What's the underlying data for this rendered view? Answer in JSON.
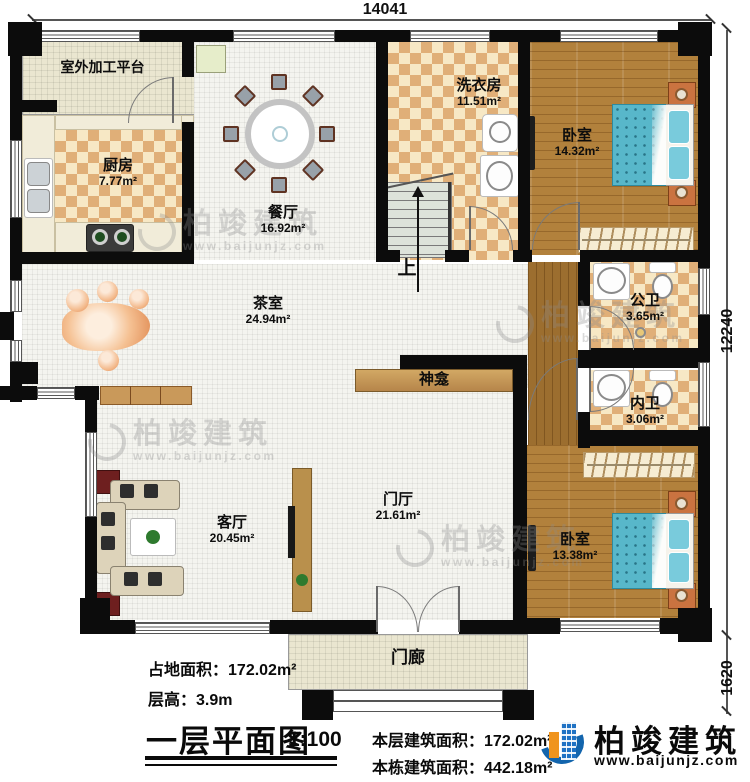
{
  "dimensions": {
    "top": "14041",
    "right_main": "12240",
    "right_porch": "1620"
  },
  "rooms": [
    {
      "name": "室外加工平台",
      "area": ""
    },
    {
      "name": "厨房",
      "area": "7.77m²"
    },
    {
      "name": "餐厅",
      "area": "16.92m²"
    },
    {
      "name": "洗衣房",
      "area": "11.51m²"
    },
    {
      "name": "卧室",
      "area": "14.32m²"
    },
    {
      "name": "茶室",
      "area": "24.94m²"
    },
    {
      "name": "公卫",
      "area": "3.65m²"
    },
    {
      "name": "内卫",
      "area": "3.06m²"
    },
    {
      "name": "神龛",
      "area": ""
    },
    {
      "name": "客厅",
      "area": "20.45m²"
    },
    {
      "name": "门厅",
      "area": "21.61m²"
    },
    {
      "name": "卧室",
      "area": "13.38m²"
    },
    {
      "name": "门廊",
      "area": ""
    }
  ],
  "stairs": {
    "up_label": "上"
  },
  "info": {
    "land_area_label": "占地面积：",
    "land_area_value": "172.02m²",
    "floor_height_label": "层高：",
    "floor_height_value": "3.9m"
  },
  "titleblock": {
    "title": "一层平面图",
    "scale": "1:100",
    "floor_area_label": "本层建筑面积：",
    "floor_area_value": "172.02m²",
    "building_area_label": "本栋建筑面积：",
    "building_area_value": "442.18m²"
  },
  "brand": {
    "name": "柏竣建筑",
    "url": "www.baijunjz.com"
  },
  "watermark": {
    "text": "柏竣建筑",
    "url": "www.baijunjz.com"
  },
  "colors": {
    "wall": "#0c0c0c",
    "wood": "#b2813c",
    "checker": "#e0af78",
    "accent_blue": "#1365ad",
    "accent_orange": "#f0941d",
    "mattress": "#58b7ca"
  }
}
